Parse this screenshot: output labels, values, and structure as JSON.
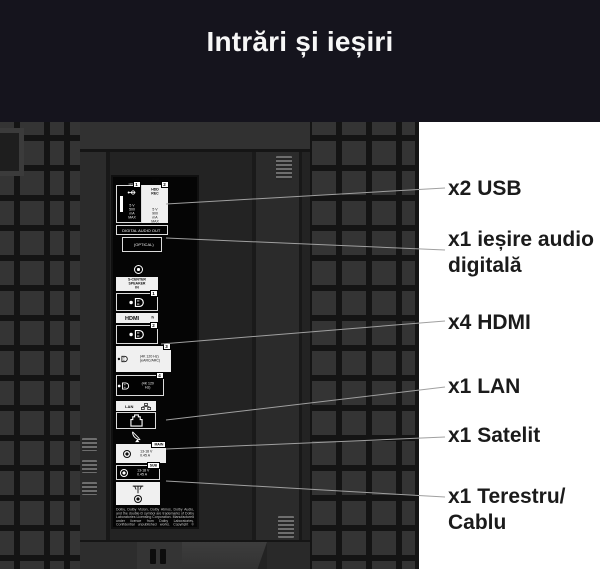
{
  "header": {
    "title": "Intrări și ieșiri"
  },
  "callouts": [
    {
      "id": "usb",
      "text": "x2 USB"
    },
    {
      "id": "audio",
      "text": "x1 ieșire audio\ndigitală"
    },
    {
      "id": "hdmi",
      "text": "x4 HDMI"
    },
    {
      "id": "lan",
      "text": "x1 LAN"
    },
    {
      "id": "satellite",
      "text": "x1 Satelit"
    },
    {
      "id": "terrestrial",
      "text": "x1 Terestru/\nCablu"
    }
  ],
  "panel": {
    "usb1": {
      "number": "1",
      "label": "USB",
      "spec": "5 V\n500 mA MAX"
    },
    "usb2": {
      "number": "2",
      "label": "USB",
      "sublabel": "HDD REC",
      "spec": "5 V\n900 mA MAX"
    },
    "digital_audio_out": {
      "label": "DIGITAL AUDIO OUT",
      "optical": "(OPTICAL)"
    },
    "s_center": {
      "label": "S-CENTER\nSPEAKER IN"
    },
    "hdmi_in": {
      "logo": "HDMI",
      "suffix": "IN"
    },
    "hdmi_ports": [
      {
        "number": "1",
        "specs": ""
      },
      {
        "number": "2",
        "specs": ""
      },
      {
        "number": "3",
        "specs": "(4K 120 Hz)\n(eARC/ARC)"
      },
      {
        "number": "4",
        "specs": "(4K 120 Hz)"
      }
    ],
    "lan": {
      "label": "LAN"
    },
    "satellite": {
      "main": "MAIN",
      "sub": "SUB",
      "main_spec": "13-18 V\n0.45 A",
      "sub_spec": "13-18 V\n0.45 A"
    },
    "legal": "Dolby, Dolby Vision, Dolby Atmos, Dolby Audio, and the double-D symbol are trademarks of Dolby Laboratories Licensing Corporation. Manufactured under licence from Dolby Laboratories. Confidential unpublished works. Copyright © 1992-2022 Dolby Laboratories. All rights reserved. For DTS patents, see http://patents.dts.com."
  },
  "colors": {
    "header_bg": "#15141d",
    "title_text": "#f7f7f7",
    "tv_body": "#2b2b2b",
    "panel_bg": "#050505",
    "background": "#ffffff",
    "callout_text": "#1b1b1b",
    "pointer_line": "#a0a0a0"
  }
}
